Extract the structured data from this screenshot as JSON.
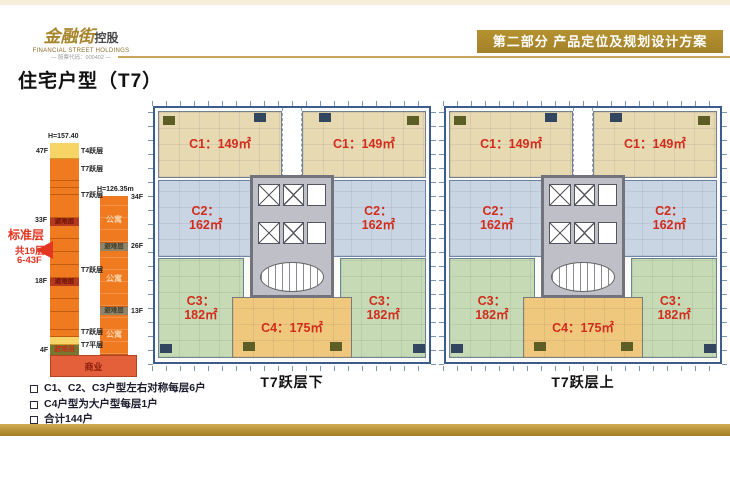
{
  "header": {
    "logo": {
      "brand": "金融街",
      "suffix": "控股",
      "subtitle": "FINANCIAL STREET HOLDINGS",
      "code": "— 股票代码：000402 —"
    },
    "banner": "第二部分 产品定位及规划设计方案"
  },
  "page_title": "住宅户型（T7）",
  "tower": {
    "left": {
      "height_label": "H=157.40",
      "floor_47": "47F",
      "floor_33": "33F",
      "floor_18": "18F",
      "floor_4": "4F",
      "label_t4_duplex": "T4跃层",
      "label_t7_duplex": "T7跃层",
      "label_t7_flat": "T7平层"
    },
    "right": {
      "height_label": "H=126.35m",
      "floor_34": "34F",
      "floor_26": "26F",
      "floor_13": "13F"
    },
    "apartment_label": "公寓",
    "refuge_label": "避难层",
    "commercial_label": "商业",
    "annotation": {
      "line1": "标准层",
      "line2": "共19层",
      "line3": "6-43F"
    }
  },
  "plans": [
    {
      "caption": "T7跃层下",
      "units": {
        "c1": {
          "name": "C1：",
          "area": "149㎡"
        },
        "c2": {
          "name": "C2：",
          "area": "162㎡"
        },
        "c3": {
          "name": "C3：",
          "area": "182㎡"
        },
        "c4": {
          "name": "C4：",
          "area": "175㎡"
        }
      }
    },
    {
      "caption": "T7跃层上",
      "units": {
        "c1": {
          "name": "C1：",
          "area": "149㎡"
        },
        "c2": {
          "name": "C2：",
          "area": "162㎡"
        },
        "c3": {
          "name": "C3：",
          "area": "182㎡"
        },
        "c4": {
          "name": "C4：",
          "area": "175㎡"
        }
      }
    }
  ],
  "notes": [
    "C1、C2、C3户型左右对称每层6户",
    "C4户型为大户型每层1户",
    "合计144户"
  ],
  "colors": {
    "banner_bg": "#ab8b2e",
    "gold_line": "#c9a45c",
    "tower_orange": "#f07a20",
    "tower_yellow": "#f7d466",
    "refuge_band_red": "#b5391d",
    "refuge_band_gray": "#8f8468",
    "commercial_band": "#e4603a",
    "unit_c1": "#e7d9b2",
    "unit_c2": "#c9d5e3",
    "unit_c3": "#c6dab6",
    "unit_c4": "#efc87e",
    "core_gray": "#bfbfc7",
    "unit_label_red": "#d22c1c",
    "plan_border": "#3c5c8e",
    "annotation_red": "#e23522"
  }
}
